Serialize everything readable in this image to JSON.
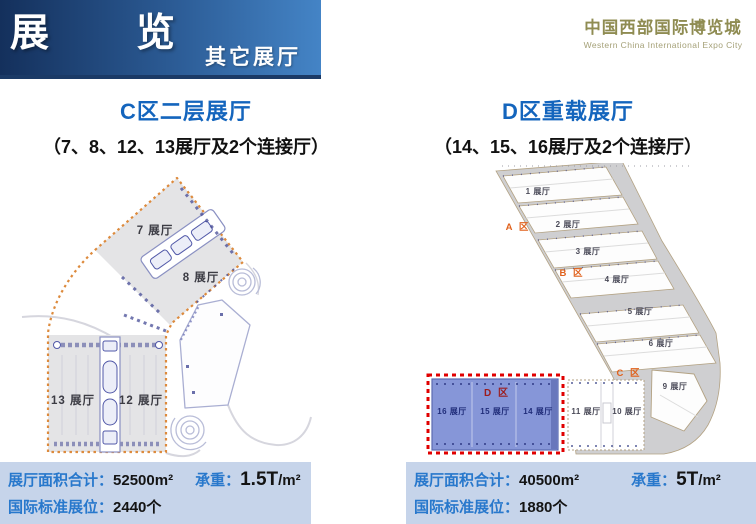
{
  "header": {
    "title": "展  览",
    "subtitle": "其它展厅"
  },
  "logo": {
    "zh": "中国西部国际博览城",
    "en": "Western China International  Expo City"
  },
  "left_section": {
    "title": "C区二层展厅",
    "subtitle": "（7、8、12、13展厅及2个连接厅）",
    "map": {
      "halls": [
        "7 展厅",
        "8 展厅",
        "12 展厅",
        "13 展厅"
      ]
    },
    "stats": {
      "area_label": "展厅面积合计：",
      "area_value": "52500",
      "area_unit": "m²",
      "load_label": "承重：",
      "load_value": "1.5T",
      "load_unit": "/m²",
      "booth_label": "国际标准展位：",
      "booth_value": "2440个"
    }
  },
  "right_section": {
    "title": "D区重载展厅",
    "subtitle": "（14、15、16展厅及2个连接厅）",
    "map": {
      "zones": [
        "A 区",
        "B 区",
        "C 区",
        "D 区"
      ],
      "halls": [
        "1 展厅",
        "2 展厅",
        "3 展厅",
        "4 展厅",
        "5 展厅",
        "6 展厅",
        "9 展厅",
        "10 展厅",
        "11 展厅",
        "14 展厅",
        "15 展厅",
        "16 展厅"
      ]
    },
    "stats": {
      "area_label": "展厅面积合计：",
      "area_value": "40500",
      "area_unit": " m²",
      "load_label": "承重：",
      "load_value": "5T",
      "load_unit": "/m²",
      "booth_label": "国际标准展位：",
      "booth_value": "1880个"
    }
  },
  "colors": {
    "banner_dark": "#14305c",
    "banner_light": "#4484c6",
    "section_title_blue": "#1465bd",
    "stats_bg": "#c6d4ea",
    "stats_label_blue": "#2878cc",
    "dzone_fill": "#8696d8",
    "dzone_dash_red": "#e00000",
    "zone_label_orange": "#e0611c",
    "map_outline_orange": "#dd8a3c",
    "map_gray": "#e4e4e6",
    "logo_gold": "#8f8c52"
  }
}
